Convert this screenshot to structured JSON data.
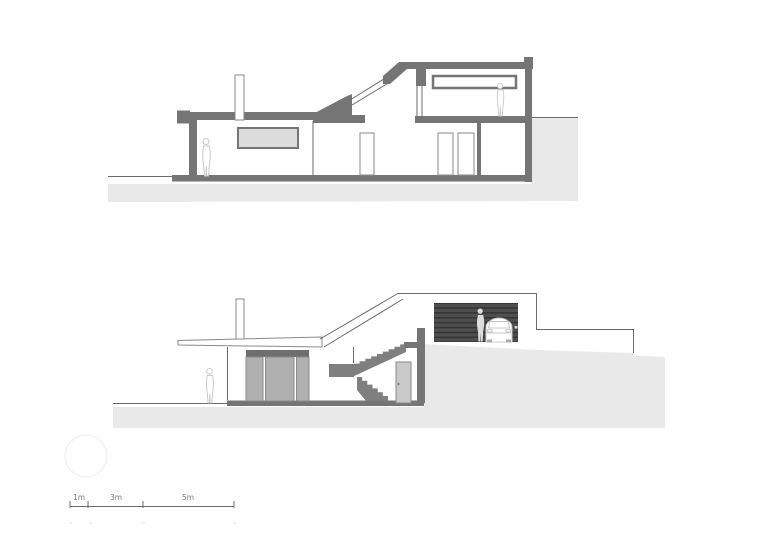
{
  "colors": {
    "background": "#ffffff",
    "wall": "#757575",
    "stair": "#7f7f7f",
    "earth": "#e9e9e9",
    "line": "#6b6b6b",
    "outline": "#8a8a8a",
    "clerestory": "#dcdcdc",
    "glass": "#b0b0b0",
    "header": "#6e6e6e",
    "door_leaf": "#c9c9c9",
    "garage_door": "#4e4e4e",
    "garage_slat": "#333333",
    "figure": "#c8c8c8",
    "figure_light": "#dedede",
    "scale_text": "#7a7a7a",
    "watermark": "#f2f2f2"
  },
  "scale_bar": {
    "labels": [
      "1m",
      "3m",
      "5m"
    ]
  }
}
